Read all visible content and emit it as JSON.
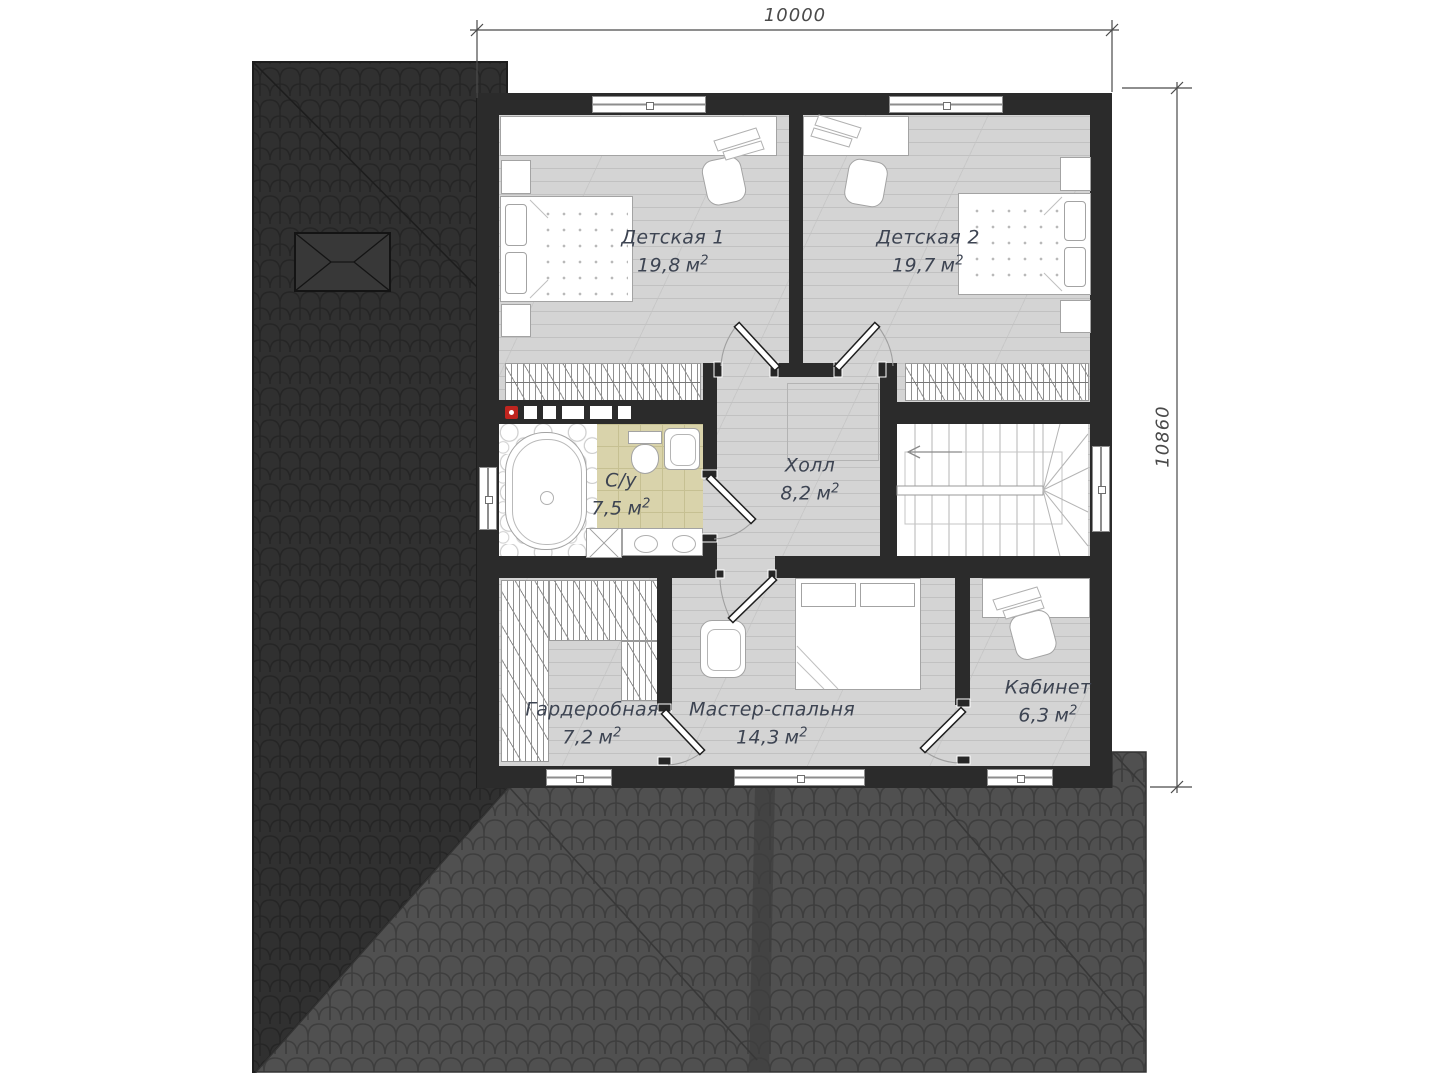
{
  "dimensions": {
    "width_mm": "10000",
    "height_mm": "10860"
  },
  "unit": "м",
  "sup": "2",
  "rooms": [
    {
      "label": "Детская 1",
      "area": "19,8"
    },
    {
      "label": "Детская 2",
      "area": "19,7"
    },
    {
      "label": "С/у",
      "area": "7,5"
    },
    {
      "label": "Холл",
      "area": "8,2"
    },
    {
      "label": "Гардеробная",
      "area": "7,2"
    },
    {
      "label": "Мастер-спальня",
      "area": "14,3"
    },
    {
      "label": "Кабинет",
      "area": "6,3"
    }
  ]
}
